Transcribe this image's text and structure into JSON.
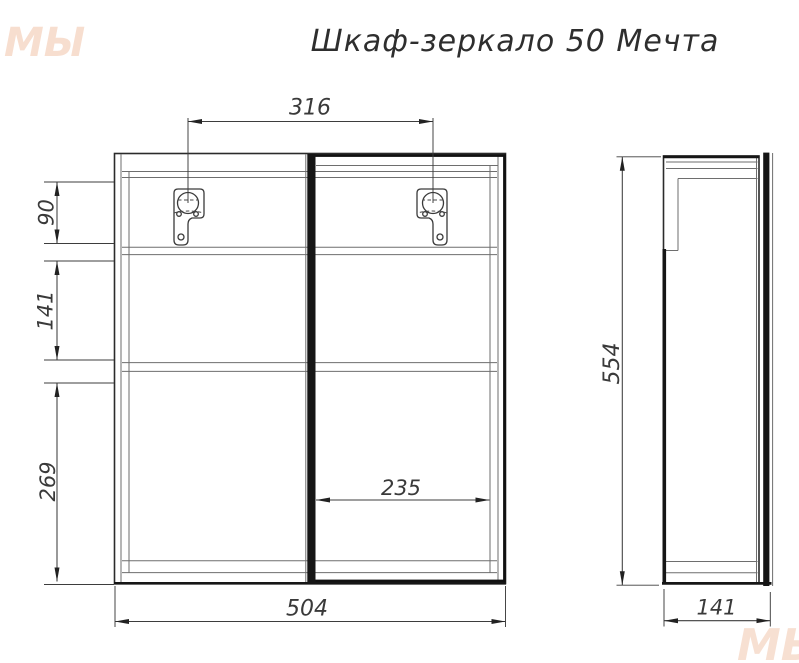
{
  "title": "Шкаф-зеркало 50 Мечта",
  "front_view": {
    "bracket_spacing": "316",
    "top_section": "90",
    "middle_section": "141",
    "bottom_section": "269",
    "door_inner_width": "235",
    "overall_width": "504"
  },
  "side_view": {
    "overall_height": "554",
    "depth": "141"
  },
  "watermark": {
    "text": "МЫ"
  },
  "colors": {
    "line_dark": "#161616",
    "line_medium": "#3d3d3d",
    "line_light": "#6e6e6e",
    "dim_text": "#3a3a3a",
    "watermark_orange": "#e89a6e",
    "background": "#ffffff"
  }
}
